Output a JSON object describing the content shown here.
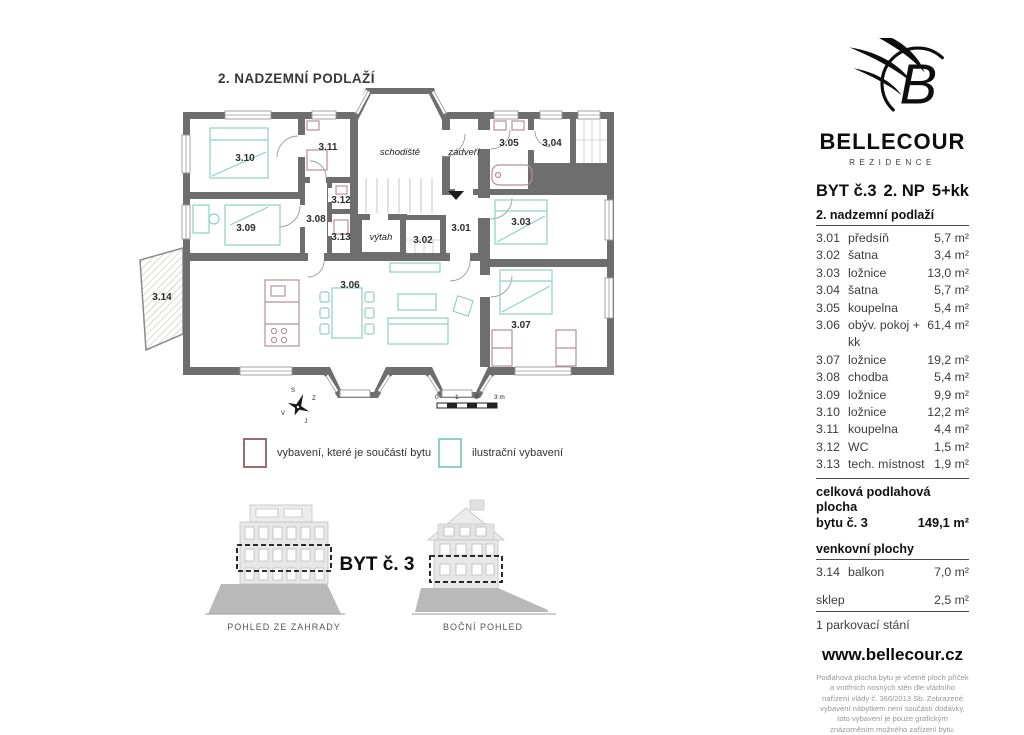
{
  "plan": {
    "title": "2. NADZEMNÍ PODLAŽÍ",
    "rooms": {
      "r301": "3.01",
      "r302": "3.02",
      "r303": "3.03",
      "r304": "3.04",
      "r305": "3.05",
      "r306": "3.06",
      "r307": "3.07",
      "r308": "3.08",
      "r309": "3.09",
      "r310": "3.10",
      "r311": "3.11",
      "r312": "3.12",
      "r313": "3.13",
      "r314": "3.14",
      "schodiste": "schodiště",
      "zadveri": "zádveří",
      "vytah": "výtah"
    },
    "compass": {
      "n": "S",
      "w": "Z",
      "e": "V",
      "s": "J"
    },
    "scale": {
      "t0": "0",
      "t1": "1",
      "t2": "2",
      "t3": "3 m"
    }
  },
  "legend": {
    "included_label": "vybavení, které je součástí bytu",
    "illustrative_label": "ilustrační vybavení",
    "included_color": "#9b6a72",
    "illustrative_color": "#8fd0c2"
  },
  "elevations": {
    "unit_label": "BYT č. 3",
    "garden_caption": "POHLED ZE ZAHRADY",
    "side_caption": "BOČNÍ POHLED"
  },
  "sidebar": {
    "brand": "BELLECOUR",
    "brand_sub": "REZIDENCE",
    "unit": "BYT č.3",
    "floor": "2. NP",
    "disposition": "5+kk",
    "floor_label": "2. nadzemní podlaží",
    "rooms": [
      {
        "num": "3.01",
        "name": "předsíň",
        "area": "5,7 m²"
      },
      {
        "num": "3.02",
        "name": "šatna",
        "area": "3,4 m²"
      },
      {
        "num": "3.03",
        "name": "ložnice",
        "area": "13,0 m²"
      },
      {
        "num": "3.04",
        "name": "šatna",
        "area": "5,7 m²"
      },
      {
        "num": "3.05",
        "name": "koupelna",
        "area": "5,4 m²"
      },
      {
        "num": "3.06",
        "name": "obýv. pokoj + kk",
        "area": "61,4 m²"
      },
      {
        "num": "3.07",
        "name": "ložnice",
        "area": "19,2 m²"
      },
      {
        "num": "3.08",
        "name": "chodba",
        "area": "5,4 m²"
      },
      {
        "num": "3.09",
        "name": "ložnice",
        "area": "9,9 m²"
      },
      {
        "num": "3.10",
        "name": "ložnice",
        "area": "12,2 m²"
      },
      {
        "num": "3.11",
        "name": "koupelna",
        "area": "4,4 m²"
      },
      {
        "num": "3.12",
        "name": "WC",
        "area": "1,5 m²"
      },
      {
        "num": "3.13",
        "name": "tech. místnost",
        "area": "1,9 m²"
      }
    ],
    "total_label_line1": "celková podlahová plocha",
    "total_label_line2": "bytu č. 3",
    "total_area": "149,1 m²",
    "outdoor_label": "venkovní plochy",
    "balcony_num": "3.14",
    "balcony_name": "balkon",
    "balcony_area": "7,0 m²",
    "cellar_name": "sklep",
    "cellar_area": "2,5 m²",
    "parking": "1 parkovací stání",
    "website": "www.bellecour.cz",
    "disclaimer": "Podlahová plocha bytu je včetně ploch příček a vnitřních nosných stěn dle vládního nařízení vlády č. 366/2013 Sb. Zobrazené vybavení nábytkem není součástí dodávky, toto vybavení je pouze grafickým znázorněním možného zařízení bytu."
  }
}
